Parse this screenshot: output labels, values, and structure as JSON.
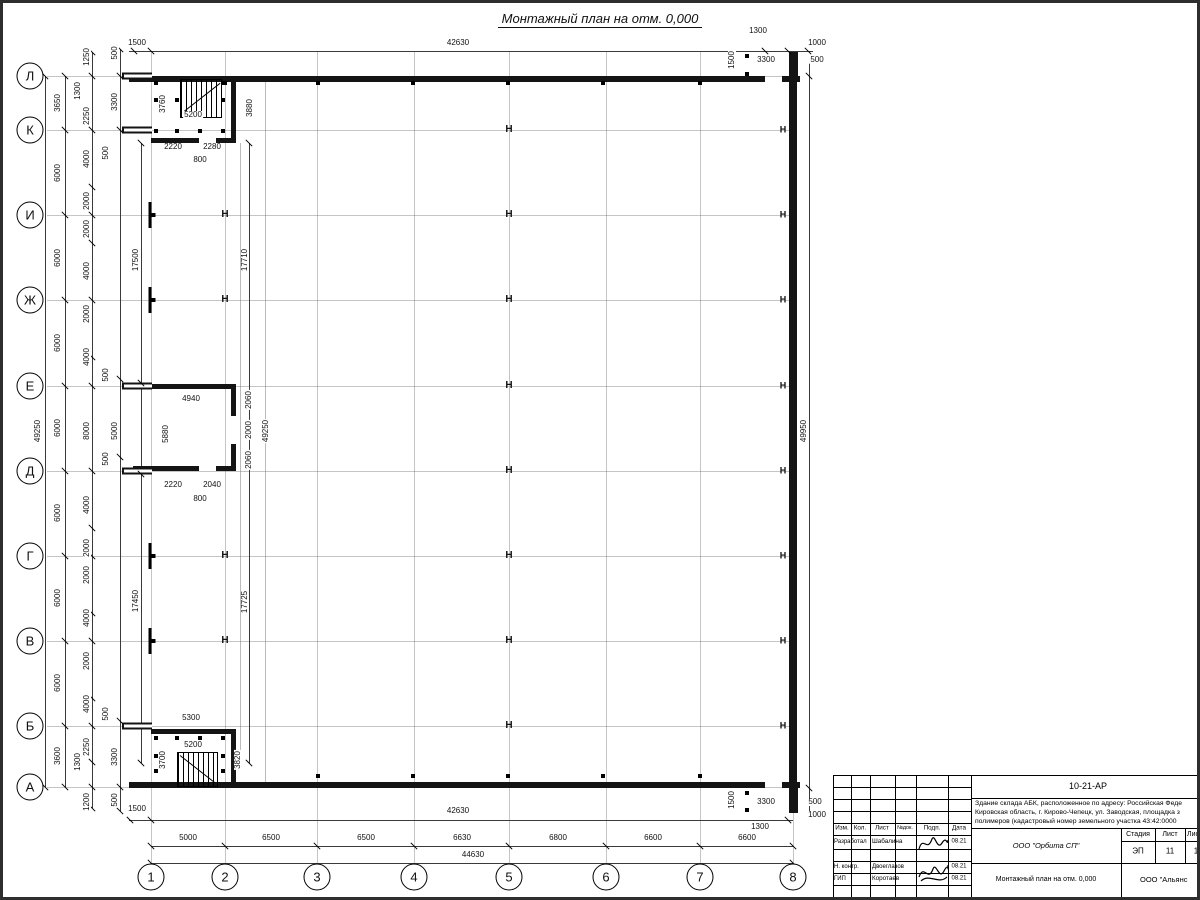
{
  "sheet": {
    "title": "Монтажный план на отм. 0,000"
  },
  "axes": {
    "rows": [
      {
        "label": "Л",
        "y": 73
      },
      {
        "label": "К",
        "y": 127
      },
      {
        "label": "И",
        "y": 212
      },
      {
        "label": "Ж",
        "y": 297
      },
      {
        "label": "Е",
        "y": 383
      },
      {
        "label": "Д",
        "y": 468
      },
      {
        "label": "Г",
        "y": 553
      },
      {
        "label": "В",
        "y": 638
      },
      {
        "label": "Б",
        "y": 723
      },
      {
        "label": "А",
        "y": 784
      }
    ],
    "cols": [
      {
        "label": "1",
        "x": 148
      },
      {
        "label": "2",
        "x": 222
      },
      {
        "label": "3",
        "x": 314
      },
      {
        "label": "4",
        "x": 411
      },
      {
        "label": "5",
        "x": 506
      },
      {
        "label": "6",
        "x": 603
      },
      {
        "label": "7",
        "x": 697
      },
      {
        "label": "8",
        "x": 790
      }
    ]
  },
  "plan": {
    "steel_column_glyph": "Н",
    "dims": [
      [
        "1500",
        134,
        40,
        0
      ],
      [
        "42630",
        455,
        40,
        0
      ],
      [
        "1300",
        755,
        28,
        0
      ],
      [
        "1000",
        814,
        40,
        0
      ],
      [
        "3300",
        763,
        57,
        0
      ],
      [
        "500",
        814,
        57,
        0
      ],
      [
        "1500",
        729,
        57,
        1
      ],
      [
        "49250",
        35,
        428,
        1
      ],
      [
        "3650",
        55,
        100,
        1
      ],
      [
        "6000",
        55,
        170,
        1
      ],
      [
        "6000",
        55,
        255,
        1
      ],
      [
        "6000",
        55,
        340,
        1
      ],
      [
        "6000",
        55,
        425,
        1
      ],
      [
        "6000",
        55,
        510,
        1
      ],
      [
        "6000",
        55,
        595,
        1
      ],
      [
        "6000",
        55,
        680,
        1
      ],
      [
        "3600",
        55,
        753,
        1
      ],
      [
        "1250",
        84,
        54,
        1
      ],
      [
        "1300",
        75,
        88,
        1
      ],
      [
        "2250",
        84,
        113,
        1
      ],
      [
        "4000",
        84,
        156,
        1
      ],
      [
        "2000",
        84,
        198,
        1
      ],
      [
        "2000",
        84,
        226,
        1
      ],
      [
        "4000",
        84,
        268,
        1
      ],
      [
        "2000",
        84,
        311,
        1
      ],
      [
        "4000",
        84,
        354,
        1
      ],
      [
        "8000",
        84,
        428,
        1
      ],
      [
        "4000",
        84,
        502,
        1
      ],
      [
        "2000",
        84,
        545,
        1
      ],
      [
        "2000",
        84,
        572,
        1
      ],
      [
        "4000",
        84,
        615,
        1
      ],
      [
        "2000",
        84,
        658,
        1
      ],
      [
        "4000",
        84,
        701,
        1
      ],
      [
        "2250",
        84,
        744,
        1
      ],
      [
        "1300",
        75,
        759,
        1
      ],
      [
        "1200",
        84,
        799,
        1
      ],
      [
        "500",
        112,
        50,
        1
      ],
      [
        "3300",
        112,
        99,
        1
      ],
      [
        "500",
        103,
        150,
        1
      ],
      [
        "500",
        103,
        372,
        1
      ],
      [
        "5000",
        112,
        428,
        1
      ],
      [
        "500",
        103,
        456,
        1
      ],
      [
        "500",
        103,
        711,
        1
      ],
      [
        "3300",
        112,
        754,
        1
      ],
      [
        "500",
        112,
        797,
        1
      ],
      [
        "17500",
        133,
        257,
        1
      ],
      [
        "17450",
        133,
        598,
        1
      ],
      [
        "3760",
        160,
        101,
        1
      ],
      [
        "5200",
        190,
        112,
        0
      ],
      [
        "3880",
        247,
        105,
        1
      ],
      [
        "2220",
        170,
        144,
        0
      ],
      [
        "2280",
        209,
        144,
        0
      ],
      [
        "800",
        197,
        157,
        0
      ],
      [
        "17710",
        242,
        257,
        1
      ],
      [
        "49250",
        263,
        428,
        1
      ],
      [
        "4940",
        188,
        396,
        0
      ],
      [
        "5880",
        163,
        431,
        1
      ],
      [
        "2060",
        246,
        397,
        1
      ],
      [
        "2000",
        246,
        427,
        1
      ],
      [
        "2060",
        246,
        457,
        1
      ],
      [
        "2220",
        170,
        482,
        0
      ],
      [
        "2040",
        209,
        482,
        0
      ],
      [
        "800",
        197,
        496,
        0
      ],
      [
        "17725",
        242,
        599,
        1
      ],
      [
        "5300",
        188,
        715,
        0
      ],
      [
        "5200",
        190,
        742,
        0
      ],
      [
        "3700",
        160,
        757,
        1
      ],
      [
        "3820",
        235,
        757,
        1
      ],
      [
        "49950",
        801,
        428,
        1
      ],
      [
        "1500",
        729,
        797,
        1
      ],
      [
        "3300",
        763,
        799,
        0
      ],
      [
        "500",
        812,
        799,
        0
      ],
      [
        "1000",
        814,
        812,
        0
      ],
      [
        "1300",
        757,
        824,
        0
      ],
      [
        "1500",
        134,
        806,
        0
      ],
      [
        "42630",
        455,
        808,
        0
      ],
      [
        "5000",
        185,
        835,
        0
      ],
      [
        "6500",
        268,
        835,
        0
      ],
      [
        "6500",
        363,
        835,
        0
      ],
      [
        "6630",
        459,
        835,
        0
      ],
      [
        "6800",
        555,
        835,
        0
      ],
      [
        "6600",
        650,
        835,
        0
      ],
      [
        "6600",
        744,
        835,
        0
      ],
      [
        "44630",
        470,
        852,
        0
      ]
    ],
    "dimlines": [
      {
        "o": "h",
        "a": 48,
        "b1": 126,
        "b2": 810,
        "t": [
          131,
          148,
          762,
          785,
          805
        ]
      },
      {
        "o": "h",
        "a": 817,
        "b1": 126,
        "b2": 790,
        "t": [
          127,
          148,
          785
        ]
      },
      {
        "o": "h",
        "a": 843,
        "b1": 148,
        "b2": 790,
        "t": [
          148,
          222,
          314,
          411,
          506,
          603,
          697,
          790
        ]
      },
      {
        "o": "h",
        "a": 860,
        "b1": 148,
        "b2": 790,
        "t": [
          148,
          790
        ]
      },
      {
        "o": "v",
        "a": 42,
        "b1": 73,
        "b2": 784,
        "t": [
          73,
          784
        ]
      },
      {
        "o": "v",
        "a": 62,
        "b1": 73,
        "b2": 784,
        "t": [
          73,
          127,
          212,
          297,
          383,
          468,
          553,
          638,
          723,
          784
        ]
      },
      {
        "o": "v",
        "a": 89,
        "b1": 49,
        "b2": 805,
        "t": [
          49,
          73,
          127,
          184,
          212,
          240,
          297,
          354,
          383,
          468,
          525,
          553,
          610,
          638,
          695,
          723,
          759,
          784,
          805
        ]
      },
      {
        "o": "v",
        "a": 117,
        "b1": 46,
        "b2": 808,
        "t": [
          46,
          73,
          127,
          376,
          454,
          718,
          784,
          808
        ]
      },
      {
        "o": "v",
        "a": 138,
        "b1": 140,
        "b2": 760,
        "t": [
          140,
          380,
          471,
          760
        ]
      },
      {
        "o": "v",
        "a": 246,
        "b1": 140,
        "b2": 760,
        "t": [
          140,
          760
        ]
      },
      {
        "o": "v",
        "a": 806,
        "b1": 60,
        "b2": 808,
        "t": [
          73,
          785
        ]
      }
    ],
    "ext_lines": [
      [
        237,
        140,
        760
      ],
      [
        262,
        73,
        784
      ]
    ],
    "steel_columns": [
      [
        222,
        212
      ],
      [
        222,
        297
      ],
      [
        222,
        553
      ],
      [
        222,
        638
      ],
      [
        506,
        127
      ],
      [
        506,
        212
      ],
      [
        506,
        297
      ],
      [
        506,
        383
      ],
      [
        506,
        468
      ],
      [
        506,
        553
      ],
      [
        506,
        638
      ],
      [
        506,
        723
      ]
    ],
    "wall_marks_right": [
      127,
      212,
      297,
      383,
      468,
      553,
      638,
      723
    ],
    "left_posts": [
      212,
      297,
      553,
      638
    ],
    "wall_stubs": [
      73,
      127,
      383,
      468,
      723
    ],
    "wall_ticks": [
      [
        222,
        80
      ],
      [
        315,
        80
      ],
      [
        410,
        80
      ],
      [
        505,
        80
      ],
      [
        600,
        80
      ],
      [
        697,
        80
      ],
      [
        315,
        773
      ],
      [
        410,
        773
      ],
      [
        505,
        773
      ],
      [
        600,
        773
      ],
      [
        697,
        773
      ],
      [
        744,
        53
      ],
      [
        744,
        71
      ],
      [
        744,
        790
      ],
      [
        744,
        807
      ]
    ],
    "dots": [
      [
        153,
        80
      ],
      [
        220,
        80
      ],
      [
        153,
        97
      ],
      [
        174,
        97
      ],
      [
        220,
        97
      ],
      [
        153,
        128
      ],
      [
        174,
        128
      ],
      [
        197,
        128
      ],
      [
        220,
        128
      ],
      [
        153,
        735
      ],
      [
        174,
        735
      ],
      [
        197,
        735
      ],
      [
        220,
        735
      ],
      [
        153,
        753
      ],
      [
        220,
        753
      ],
      [
        153,
        768
      ],
      [
        220,
        768
      ]
    ]
  },
  "title_block": {
    "doc_code": "10-21-АР",
    "desc_line1": "Здание склада АБК, расположенное по адресу: Российская Феде",
    "desc_line2": "Кировская область, г. Кирово-Чепецк, ул. Заводская, площадка з",
    "desc_line3": "полимеров (кадастровый номер земельного участка 43:42:0000",
    "headers": {
      "izm": "Изм.",
      "kol": "Кол.",
      "list": "Лист",
      "ndok": "№док.",
      "podp": "Подп.",
      "data": "Дата"
    },
    "rows": [
      {
        "role": "Разработал",
        "name": "Шабалина",
        "date": "08.21"
      },
      {
        "role": "Н. контр.",
        "name": "Двоеглазов",
        "date": "08.21"
      },
      {
        "role": "ГИП",
        "name": "Коротаев",
        "date": "08.21"
      }
    ],
    "org1": "ООО \"Орбита СП\"",
    "plan_title": "Монтажный план на отм. 0,000",
    "stage_label": "Стадия",
    "sheet_label": "Лист",
    "sheets_label": "Листов",
    "stage_val": "ЭП",
    "sheet_val": "11",
    "sheets_val": "1",
    "org2": "ООО \"Альянс"
  }
}
